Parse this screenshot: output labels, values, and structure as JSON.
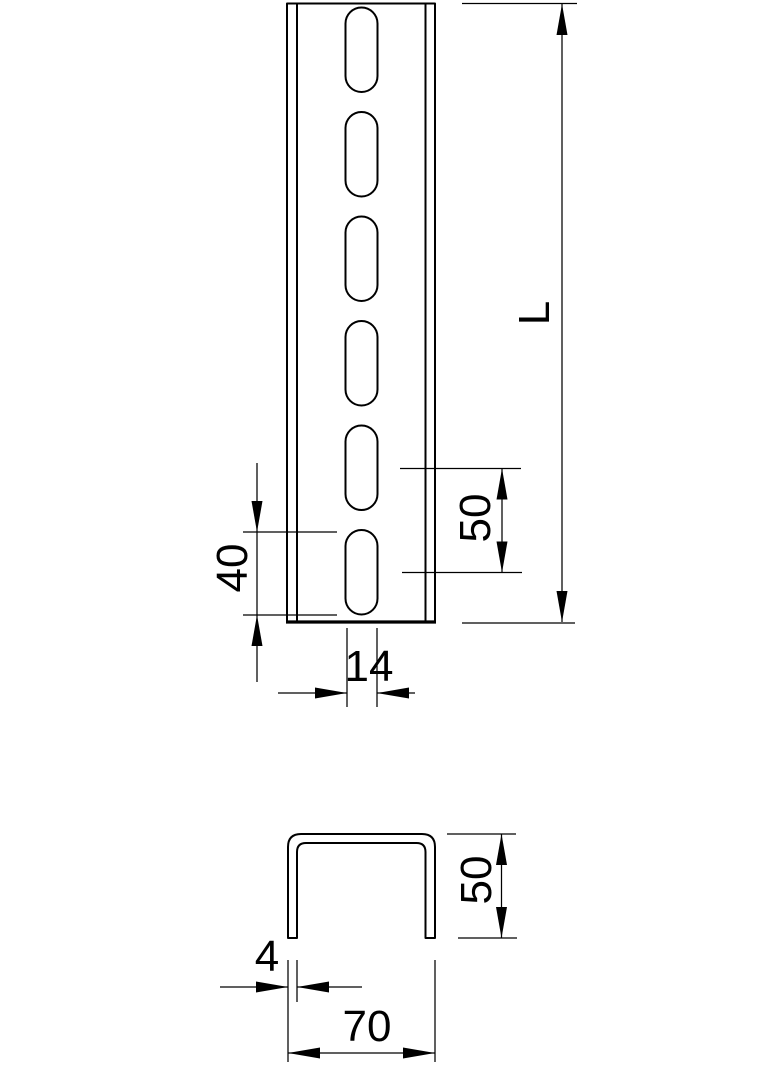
{
  "drawing": {
    "title": "slotted-u-profile-rail-dimension-drawing",
    "colors": {
      "line": "#000000",
      "background": "#ffffff"
    },
    "views": {
      "front": {
        "name": "front view of slotted rail",
        "slot_count": 6,
        "dims": {
          "length": "L",
          "slot_pitch": "50",
          "slot_length": "40",
          "slot_width": "14"
        }
      },
      "section": {
        "name": "U cross-section",
        "dims": {
          "height": "50",
          "wall_thickness": "4",
          "width": "70"
        }
      }
    }
  }
}
